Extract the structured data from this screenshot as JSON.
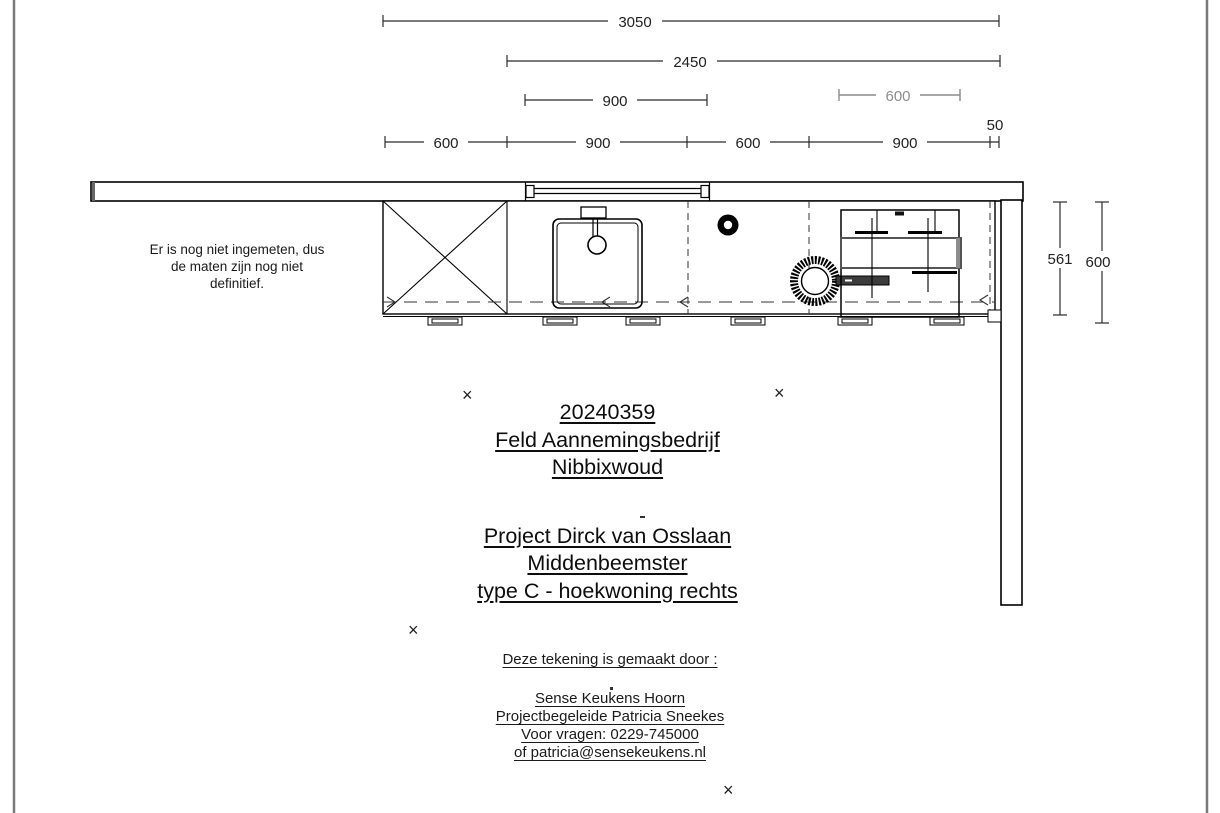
{
  "note": {
    "line1": "Er is nog niet ingemeten, dus",
    "line2": "de maten zijn nog niet",
    "line3": "definitief."
  },
  "title_block": {
    "order_number": "20240359",
    "company": "Feld Aannemingsbedrijf",
    "city": "Nibbixwoud",
    "project_line1": "Project Dirck van Osslaan",
    "project_line2": "Middenbeemster",
    "project_line3": "type C - hoekwoning rechts"
  },
  "footer": {
    "heading": "Deze tekening is gemaakt door :",
    "company": "Sense Keukens Hoorn",
    "contact": "Projectbegeleide Patricia Sneekes",
    "phone_line": "Voor vragen: 0229-745000",
    "email_line": "of patricia@sensekeukens.nl"
  },
  "dimensions": {
    "total_width": "3050",
    "run_width": "2450",
    "window_width": "900",
    "hob_width": "600",
    "seg1": "600",
    "seg2": "900",
    "seg3": "600",
    "seg4": "900",
    "seg5": "50",
    "depth_inner": "561",
    "depth_total": "600"
  },
  "markers": {
    "symbol": "×"
  },
  "colors": {
    "line": "#000000",
    "dim_gray": "#8c8c8c",
    "page_border": "#7a7a7a"
  }
}
